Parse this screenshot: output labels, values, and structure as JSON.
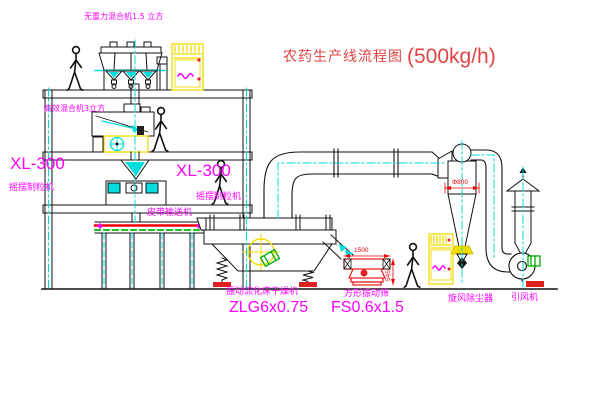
{
  "title": {
    "text": "农药生产线流程图",
    "capacity": "(500kg/h)"
  },
  "labels": {
    "roof_mixer": "无重力混合机1.5 立方",
    "floor_mixer": "高效混合机3立方",
    "granulator_left": {
      "model": "XL-300",
      "name": "摇摆制粒机"
    },
    "granulator_right": {
      "model": "XL-300",
      "name": "摇摆制粒机"
    },
    "belt_conveyor": "皮带输送机",
    "dryer": {
      "name": "振动流化床干燥机",
      "model": "ZLG6x0.75"
    },
    "screen": {
      "name": "方形振动筛",
      "model": "FS0.6x1.5"
    },
    "cyclone": {
      "name": "旋风除尘器"
    },
    "fan": {
      "name": "引风机"
    }
  },
  "dimensions": {
    "cyclone_diameter": "Φ800",
    "screen_length": "1500",
    "screen_height": "545"
  },
  "colors": {
    "label_magenta": "#ff00ff",
    "title_red": "#e04444",
    "dimension_red": "#f00000",
    "line_black": "#1a1a1a",
    "centerline_cyan": "#00dddd",
    "accent_yellow": "#f0dc00",
    "motor_green": "#00aa00"
  }
}
